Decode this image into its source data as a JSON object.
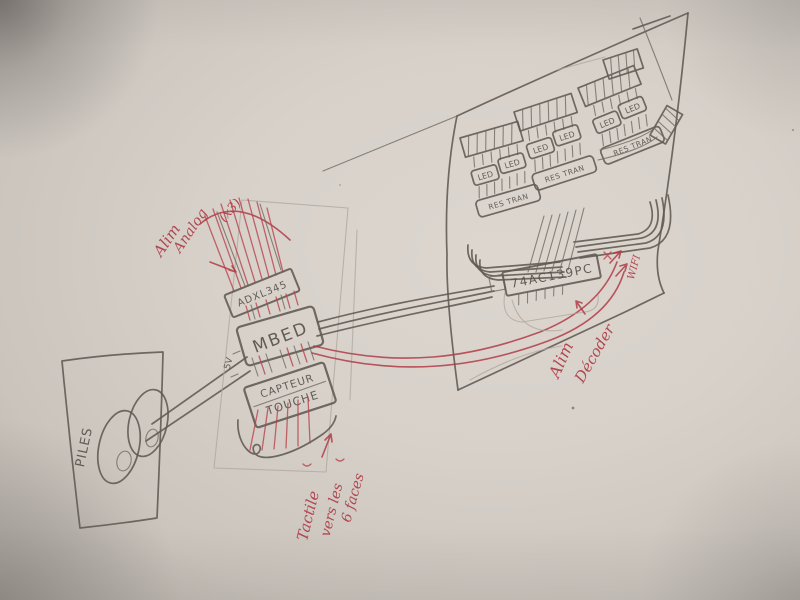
{
  "colors": {
    "paper": "#d7d1ca",
    "pencil": "#5f5952",
    "red_ink": "#b23b46"
  },
  "battery": {
    "label": "PILES"
  },
  "mbed_cluster": {
    "accelerometer_label": "ADXL345",
    "mbed_label": "MBED",
    "supply_label": "5V",
    "touch_sensor_line1": "CAPTEUR",
    "touch_sensor_line2": "TOUCHE"
  },
  "board": {
    "chip_label": "74AC139PC",
    "led_label": "LED",
    "res_tran_label": "RES TRAN"
  },
  "annotations": {
    "alim_analog_line1": "Alim",
    "alim_analog_line2": "Analog",
    "alim_analog_line3": "(x3)",
    "tactile_line1": "Tactile",
    "tactile_line2": "vers les",
    "tactile_line3": "6 faces",
    "alim_decoder_line1": "Alim",
    "alim_decoder_line2": "Décoder",
    "wifi_label": "WIFI"
  }
}
